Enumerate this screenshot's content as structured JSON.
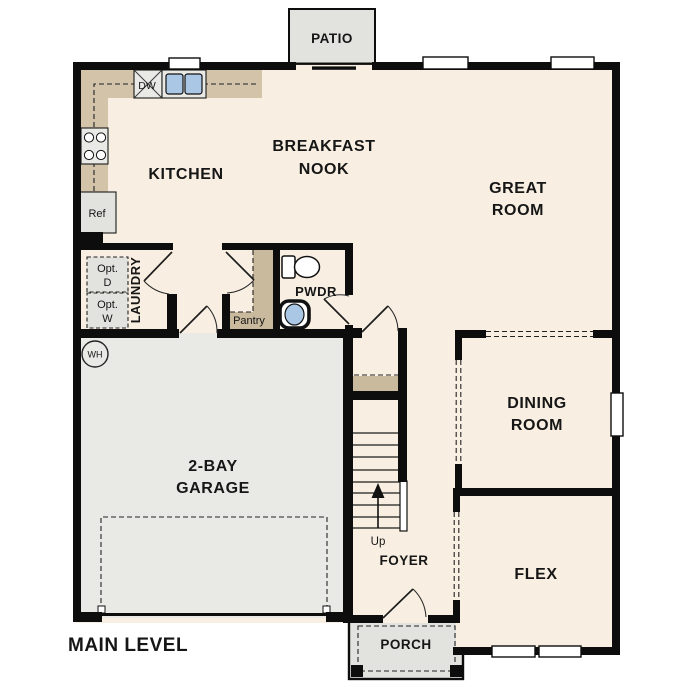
{
  "plan_title": "MAIN LEVEL",
  "rooms": {
    "patio": {
      "label": "PATIO"
    },
    "breakfast_nook": {
      "label_line1": "BREAKFAST",
      "label_line2": "NOOK"
    },
    "kitchen": {
      "label": "KITCHEN"
    },
    "great_room": {
      "label_line1": "GREAT",
      "label_line2": "ROOM"
    },
    "laundry": {
      "label": "LAUNDRY",
      "opt_dryer": {
        "line1": "Opt.",
        "line2": "D"
      },
      "opt_washer": {
        "line1": "Opt.",
        "line2": "W"
      }
    },
    "pantry": {
      "label": "Pantry"
    },
    "powder_room": {
      "label": "PWDR"
    },
    "garage": {
      "label_line1": "2-BAY",
      "label_line2": "GARAGE",
      "water_heater": "WH"
    },
    "dining_room": {
      "label_line1": "DINING",
      "label_line2": "ROOM"
    },
    "flex": {
      "label": "FLEX"
    },
    "foyer": {
      "label": "FOYER"
    },
    "stairs": {
      "direction": "Up"
    },
    "porch": {
      "label": "PORCH"
    }
  },
  "appliances": {
    "dishwasher": "DW",
    "refrigerator": "Ref"
  },
  "colors": {
    "wall": "#0d0d0d",
    "floor": "#f8efe2",
    "garage_floor": "#e9e9e6",
    "concrete": "#e2e2df",
    "counter": "#d2c3a9",
    "shelf": "#c9b99d",
    "fixture_water": "#aac8e6"
  }
}
